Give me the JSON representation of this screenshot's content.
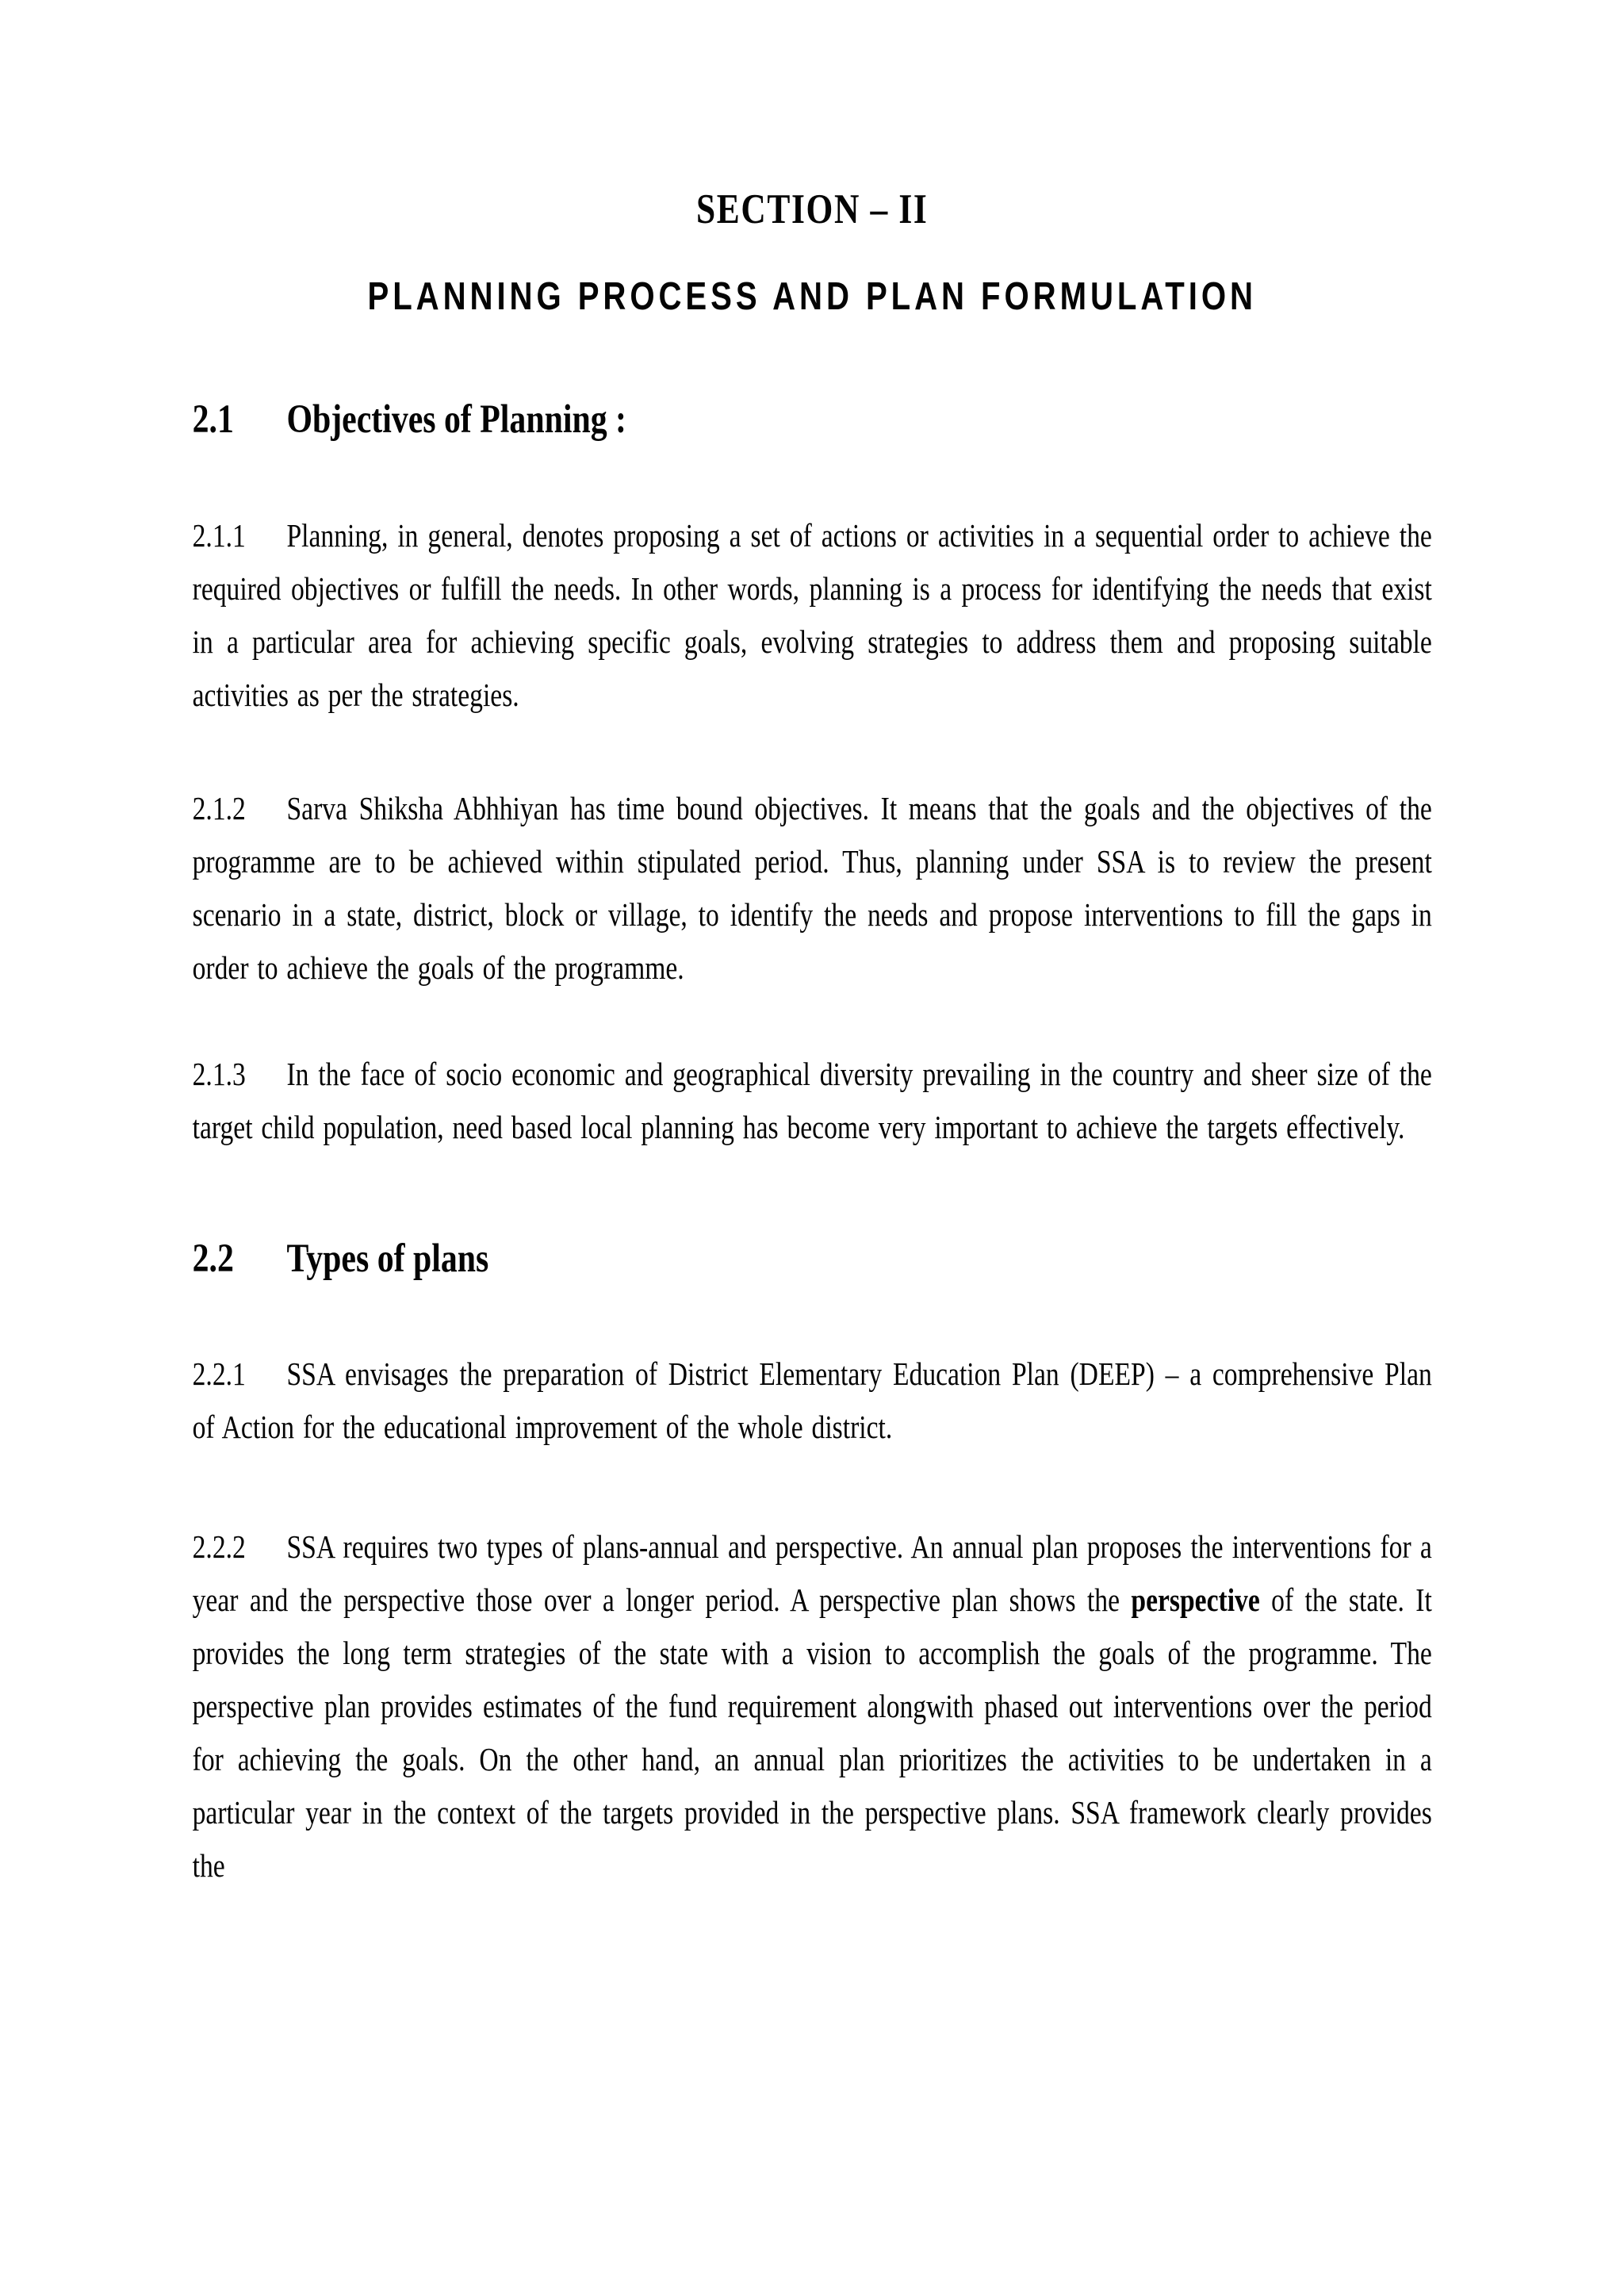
{
  "doc": {
    "section_title": "SECTION – II",
    "main_title": "PLANNING PROCESS AND PLAN FORMULATION",
    "sections": [
      {
        "number": "2.1",
        "heading": "Objectives of Planning :",
        "paragraphs": [
          {
            "number": "2.1.1",
            "text": "Planning, in general, denotes proposing a set of actions or activities in a sequential order to achieve the required objectives or fulfill the needs. In other words, planning is a process for identifying the needs that exist in a particular area for achieving specific goals, evolving strategies to address them and proposing suitable activities as per the strategies."
          },
          {
            "number": "2.1.2",
            "text": "Sarva Shiksha Abhhiyan has time bound objectives. It means that the goals and the objectives of the programme are to be achieved within stipulated period. Thus, planning under SSA is to review the present scenario in a state, district, block or village, to identify the needs and propose interventions to fill the gaps in order to achieve the goals of the programme."
          },
          {
            "number": "2.1.3",
            "text": "In the face of socio economic and geographical diversity prevailing in the country and sheer size of the target child population, need based local planning has become very important to achieve the targets effectively."
          }
        ]
      },
      {
        "number": "2.2",
        "heading": "Types of plans",
        "paragraphs": [
          {
            "number": "2.2.1",
            "text": "SSA envisages the preparation of District Elementary Education Plan (DEEP) – a comprehensive Plan of Action for the educational improvement of the whole district."
          },
          {
            "number": "2.2.2",
            "text_before": "SSA requires two types of plans-annual and perspective. An annual plan proposes the interventions for a year and the perspective those over a longer period. A perspective plan shows the ",
            "bold_word": "perspective",
            "text_after": " of the state. It provides the long term strategies of the state with a vision to accomplish the goals of the programme. The perspective plan provides estimates of the fund requirement alongwith phased out interventions over the period for achieving the goals. On the other hand, an annual plan prioritizes the activities to be undertaken in a particular year in the context of the targets provided in the perspective plans. SSA framework clearly provides the"
          }
        ]
      }
    ]
  }
}
